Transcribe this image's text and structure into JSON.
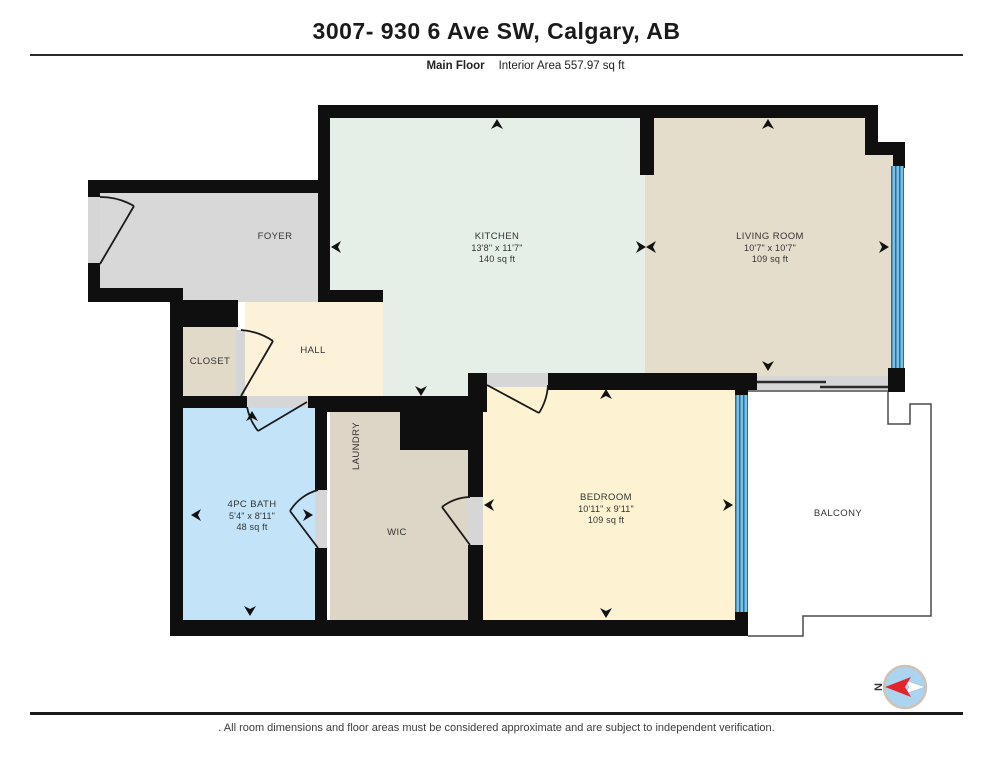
{
  "header": {
    "title": "3007- 930 6 Ave SW, Calgary, AB",
    "floor_label": "Main Floor",
    "area_label": "Interior Area 557.97 sq ft"
  },
  "rooms": {
    "foyer": {
      "name": "FOYER"
    },
    "kitchen": {
      "name": "KITCHEN",
      "dims": "13'8\" x 11'7\"",
      "area": "140 sq ft"
    },
    "living": {
      "name": "LIVING ROOM",
      "dims": "10'7\" x 10'7\"",
      "area": "109 sq ft"
    },
    "closet": {
      "name": "CLOSET"
    },
    "hall": {
      "name": "HALL"
    },
    "laundry": {
      "name": "LAUNDRY"
    },
    "bath": {
      "name": "4PC BATH",
      "dims": "5'4\" x 8'11\"",
      "area": "48 sq ft"
    },
    "wic": {
      "name": "WIC"
    },
    "bedroom": {
      "name": "BEDROOM",
      "dims": "10'11\" x 9'11\"",
      "area": "109 sq ft"
    },
    "balcony": {
      "name": "BALCONY"
    }
  },
  "compass": {
    "north_label": "N"
  },
  "footer": {
    "disclaimer": ". All room dimensions and floor areas must be considered approximate and are subject to independent verification."
  },
  "colors": {
    "wall": "#0f0f0f",
    "window_glass": "#4aa2d7",
    "kitchen_floor": "#e5efe8",
    "living_floor": "#e5ddcb",
    "bedroom_floor": "#fdf3d2",
    "hall_floor": "#fcf2d9",
    "foyer_floor": "#d8d8d8",
    "closet_floor": "#e2dac9",
    "laundry_wic_floor": "#ddd5c5",
    "bath_floor": "#c3e4f8",
    "door_threshold": "#d6d6d6",
    "compass_needle_red": "#e3242b",
    "compass_fill_blue": "#aad4f0"
  }
}
